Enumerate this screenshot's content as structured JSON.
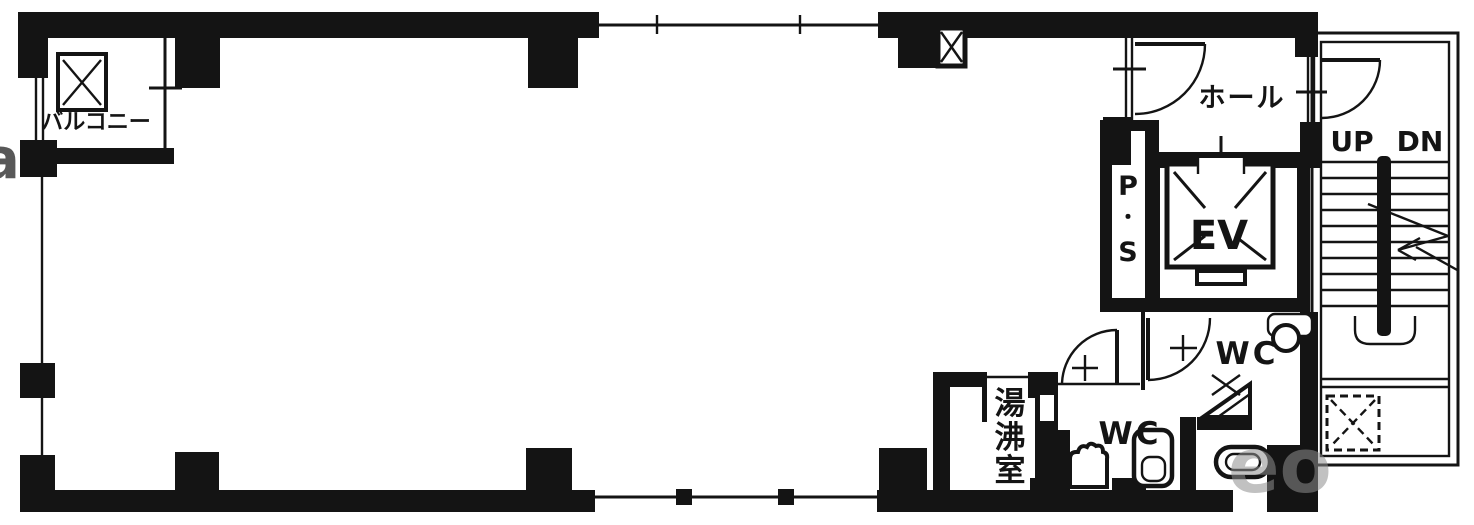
{
  "plan": {
    "type": "building-floor-plan",
    "labels": {
      "balcony": "バルコニー",
      "hall": "ホール",
      "pipe_shaft": {
        "p": "P",
        "dot": "・",
        "s": "S"
      },
      "elevator": "EV",
      "stairs": {
        "up": "UP",
        "dn": "DN"
      },
      "wc_upper": "WC",
      "wc_middle": "WC",
      "kitchenette": {
        "c1": "湯",
        "c2": "沸",
        "c3": "室"
      }
    },
    "watermark": {
      "fragment_right": "eo",
      "fragment_left": "a"
    },
    "colors": {
      "wall": "#141414",
      "background": "#ffffff",
      "watermark": "#8f8f8f"
    }
  }
}
